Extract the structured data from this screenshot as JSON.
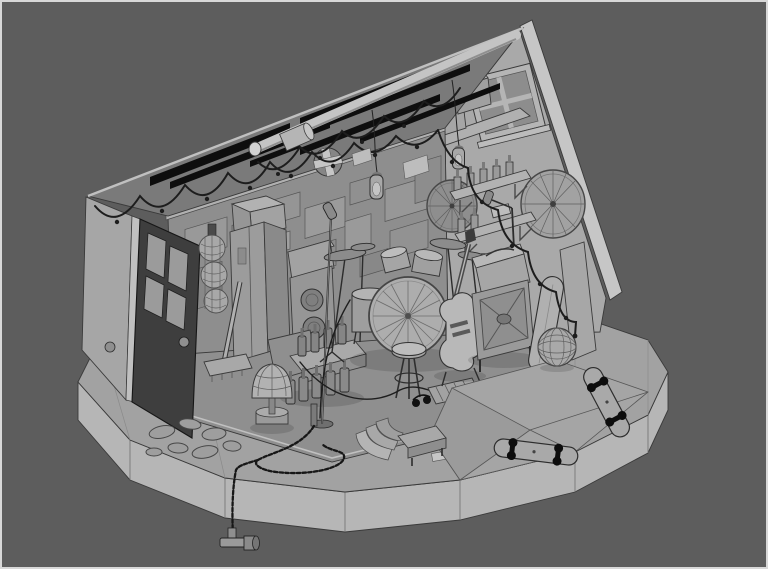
{
  "canvas": {
    "width": 768,
    "height": 569
  },
  "palette": {
    "background": "#5d5d5d",
    "frame_border": "#d8d8d8",
    "platform_top": "#a2a2a2",
    "platform_rim": "#b6b6b6",
    "stage_floor": "#8f8f8f",
    "back_wall": "#8e8e8e",
    "right_wall": "#a9a9a9",
    "left_wall_exterior": "#a6a6a6",
    "roof_underside": "#7a7a7a",
    "roof_gap": "#0e0e0e",
    "ridge_beam": "#c4c4c4",
    "roof_fascia": "#c6c6c6",
    "door": "#3e3e3e",
    "outline": "#3a3a3a",
    "object_mid": "#9a9a9a",
    "object_light": "#b4b4b4",
    "object_dark": "#6f6f6f"
  },
  "scene": {
    "type": "3d-viewport-render",
    "style": "untextured-clay-wireframe-grayscale",
    "subject": "isometric-garage-band-room-diorama",
    "objects": [
      {
        "id": "base-platform",
        "label": "faceted round base platform"
      },
      {
        "id": "roof",
        "label": "pitched roof with open rafter gaps"
      },
      {
        "id": "ridge-beam",
        "label": "round ridge beam with end cap"
      },
      {
        "id": "right-gable-wall",
        "label": "right gable wall with window"
      },
      {
        "id": "back-wall",
        "label": "back wall with acoustic panels"
      },
      {
        "id": "left-wall",
        "label": "left wall with open door"
      },
      {
        "id": "door-open",
        "label": "dark open door with four panes"
      },
      {
        "id": "string-lights",
        "label": "string light garlands"
      },
      {
        "id": "hanging-lamps",
        "label": "two hanging caged bulbs"
      },
      {
        "id": "ceiling-fan-vent",
        "label": "round wall vent with cross"
      },
      {
        "id": "bicycle-wheels",
        "label": "two spoked wheels on walls"
      },
      {
        "id": "wall-shelves",
        "label": "shelves with bottles and cans"
      },
      {
        "id": "ball-net",
        "label": "net bag with three balls"
      },
      {
        "id": "locker-cabinet",
        "label": "tall locker with boxes on top"
      },
      {
        "id": "amp-stack",
        "label": "speaker amp stack"
      },
      {
        "id": "drum-kit",
        "label": "drum kit with radial bass drum"
      },
      {
        "id": "stool",
        "label": "round stool"
      },
      {
        "id": "mic-stands",
        "label": "microphone stands"
      },
      {
        "id": "electric-guitar",
        "label": "electric guitar on stand"
      },
      {
        "id": "organ-amp",
        "label": "amp head on cross-grille cabinet"
      },
      {
        "id": "snowboard",
        "label": "leaning deck"
      },
      {
        "id": "leaning-board",
        "label": "leaning flat panel"
      },
      {
        "id": "wireframe-ball",
        "label": "wireframe sphere ball"
      },
      {
        "id": "skateboards",
        "label": "two skateboards on ramp"
      },
      {
        "id": "skate-ramp",
        "label": "faceted skate ramp"
      },
      {
        "id": "bottle-crate",
        "label": "bottle crate and bottle rows"
      },
      {
        "id": "table-lamp",
        "label": "dome table lamp"
      },
      {
        "id": "broom",
        "label": "broom against wall"
      },
      {
        "id": "stepping-stones",
        "label": "stepping stones"
      },
      {
        "id": "chain",
        "label": "chain coil with hanging handle"
      },
      {
        "id": "curved-steps",
        "label": "curved corner steps"
      },
      {
        "id": "pedalboard",
        "label": "slatted pedal board"
      },
      {
        "id": "cables",
        "label": "stage cables"
      },
      {
        "id": "loft-boxes",
        "label": "cardboard boxes on loft"
      },
      {
        "id": "window",
        "label": "four-pane gable window"
      }
    ]
  }
}
